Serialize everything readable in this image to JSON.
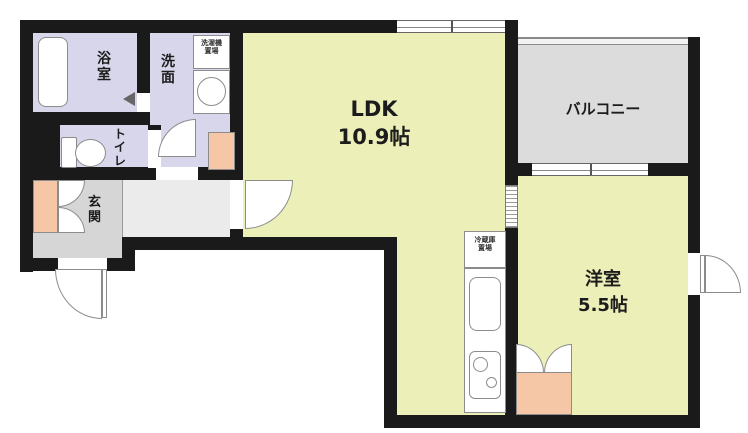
{
  "rooms": {
    "ldk": {
      "name": "LDK",
      "size": "10.9帖"
    },
    "yoshitsu": {
      "name": "洋室",
      "size": "5.5帖"
    },
    "balcony": {
      "name": "バルコニー"
    },
    "bath": {
      "name": "浴室"
    },
    "senmen": {
      "name": "洗面"
    },
    "toilet": {
      "name": "トイレ"
    },
    "genkan": {
      "name": "玄関"
    },
    "ps": {
      "name": "PS"
    },
    "laundry": {
      "line1": "洗濯機",
      "line2": "置場"
    },
    "fridge": {
      "line1": "冷蔵庫",
      "line2": "置場"
    }
  },
  "colors": {
    "wall": "#1a1a1a",
    "room_yellow": "#edefb9",
    "wet_lavender": "#d7d6ea",
    "balcony_gray": "#dcdcdc",
    "genkan_gray": "#d6d6d6",
    "corridor_gray": "#ebebeb",
    "closet_pink": "#f6c7a7",
    "fixture_line": "#8c8c8c"
  }
}
